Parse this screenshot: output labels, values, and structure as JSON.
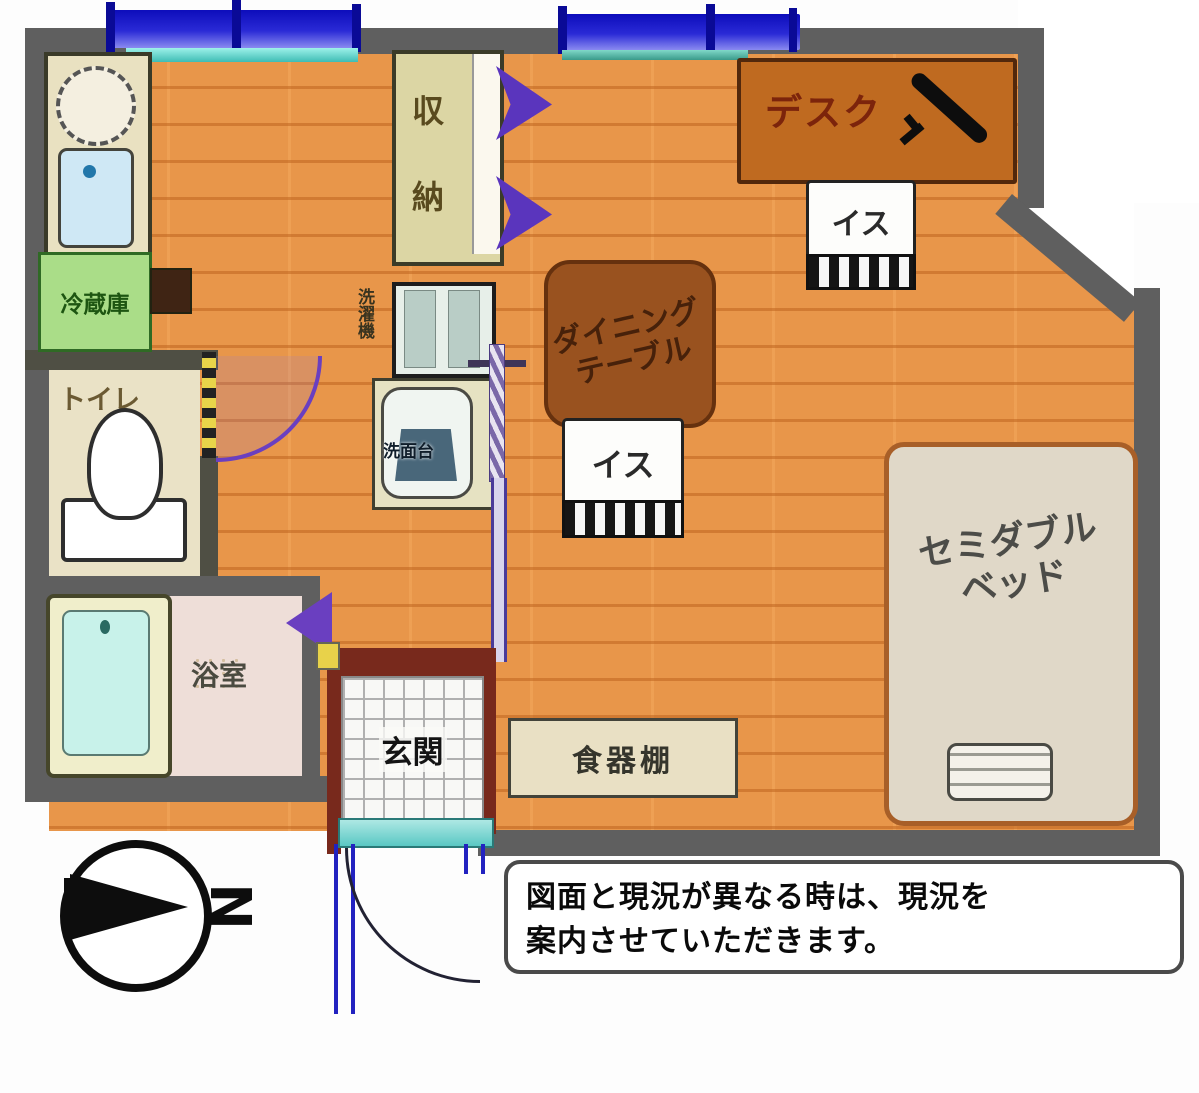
{
  "plan_title": "1R apartment floor plan",
  "rooms": {
    "toilet": "トイレ",
    "bathroom": "浴室",
    "entrance": "玄関",
    "storage_char1": "収",
    "storage_char2": "納"
  },
  "fixtures": {
    "refrigerator": "冷蔵庫",
    "washer": "洗濯機",
    "washbasin": "洗面台",
    "cupboard": "食器棚"
  },
  "furniture": {
    "desk": "デスク",
    "chair_top": "イス",
    "chair_bottom": "イス",
    "dining_line1": "ダイニング",
    "dining_line2": "テーブル",
    "bed_line1": "セミダブル",
    "bed_line2": "ベッド"
  },
  "compass": {
    "north": "N"
  },
  "disclaimer": {
    "line1": "図面と現況が異なる時は、現況を",
    "line2": "案内させていただきます。"
  },
  "colors": {
    "floor": "#e8964a",
    "wall": "#5f5f5f",
    "window_blue": "#1c1cc4",
    "sill_cyan": "#7fe0da",
    "fridge_green": "#aadd88",
    "door_purple": "#6a3fc0",
    "desk_brown": "#bf6a20",
    "table_brown": "#99521f",
    "bed_beige": "#e0d8c8",
    "entrance_maroon": "#78291c",
    "tub_cyan": "#c8f2ea"
  }
}
